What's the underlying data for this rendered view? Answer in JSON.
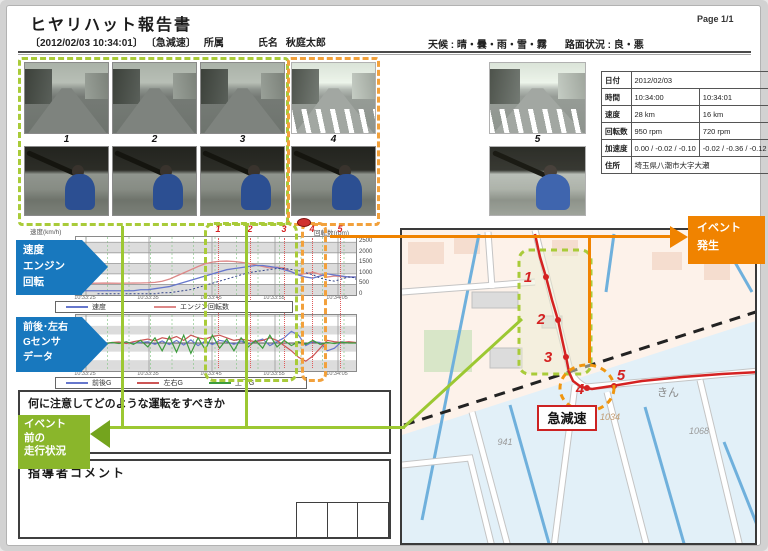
{
  "page": {
    "title": "ヒヤリハット報告書",
    "page_label": "Page 1/1",
    "timestamp": "〔2012/02/03 10:34:01〕",
    "event_type": "〔急減速〕",
    "affiliation_label": "所属",
    "name_label": "氏名",
    "person_name": "秋庭太郎",
    "weather": "天候 : 晴・曇・雨・雪・霧",
    "road_condition": "路面状況 : 良・悪"
  },
  "cameras": {
    "frames": [
      {
        "label": "1"
      },
      {
        "label": "2"
      },
      {
        "label": "3"
      },
      {
        "label": "4"
      },
      {
        "label": "5"
      }
    ]
  },
  "info_table": {
    "rows": [
      {
        "label": "日付",
        "values": [
          "2012/02/03"
        ]
      },
      {
        "label": "時間",
        "values": [
          "10:34:00",
          "10:34:01"
        ]
      },
      {
        "label": "速度",
        "values": [
          "28 km",
          "16 km"
        ]
      },
      {
        "label": "回転数",
        "values": [
          "950 rpm",
          "720 rpm"
        ]
      },
      {
        "label": "加速度",
        "values": [
          "0.00 / -0.02 / -0.10",
          "-0.02 / -0.36 / -0.12"
        ]
      },
      {
        "label": "住所",
        "values": [
          "埼玉県八潮市大字大瀬"
        ]
      }
    ]
  },
  "connectors": {
    "event_occur_lines": [
      "イベント",
      "発生"
    ],
    "event_before_lines": [
      "イベント",
      "前の",
      "走行状況"
    ],
    "colors": {
      "orange": "#f08300",
      "olive": "#9cc832"
    }
  },
  "arrow_labels": {
    "speed_engine_lines": [
      "速度",
      "エンジン",
      "回転"
    ],
    "gsensor_lines": [
      "前後･左右",
      "Gセンサ",
      "データ"
    ]
  },
  "chart_data": [
    {
      "type": "line",
      "title": "速度・エンジン回転",
      "left_axis_label": "速度(km/h)",
      "right_axis_label": "回転数(rpm)",
      "yticks_right": [
        "2500",
        "2000",
        "1500",
        "1000",
        "500",
        "0"
      ],
      "ylim_rpm": [
        0,
        2750
      ],
      "x": [
        "10:33:25",
        "10:33:35",
        "10:33:45",
        "10:33:55",
        "10:34:05"
      ],
      "event_markers": [
        "1",
        "2",
        "3",
        "4",
        "5"
      ],
      "series": [
        {
          "name": "速度",
          "color": "#6677cc",
          "unit": "km/h",
          "values": [
            4,
            4,
            4,
            4,
            4,
            4,
            4,
            4,
            4,
            5,
            5,
            6,
            7,
            8,
            10,
            12,
            14,
            16,
            18,
            20,
            22,
            24,
            25,
            26,
            27,
            28,
            28,
            27,
            26,
            24,
            22,
            19,
            17,
            16,
            18,
            20,
            19,
            18,
            17,
            17
          ]
        },
        {
          "name": "エンジン回転数",
          "color": "#dd8888",
          "unit": "rpm",
          "values": [
            560,
            560,
            555,
            560,
            565,
            560,
            558,
            562,
            565,
            570,
            580,
            600,
            650,
            750,
            900,
            1050,
            1200,
            1350,
            1480,
            1560,
            1600,
            1610,
            1590,
            1550,
            1500,
            1430,
            1350,
            1280,
            1320,
            1280,
            1100,
            950,
            1020,
            1080,
            980,
            850,
            900,
            870,
            860,
            850
          ]
        }
      ],
      "legend_position": "bottom"
    },
    {
      "type": "line",
      "title": "前後・左右Gセンサデータ",
      "ylim_g": [
        -1,
        1
      ],
      "x": [
        "10:33:25",
        "10:33:35",
        "10:33:45",
        "10:33:55",
        "10:34:05"
      ],
      "series": [
        {
          "name": "前後G",
          "color": "#6677cc",
          "values": [
            0,
            0,
            0.02,
            -0.02,
            0.01,
            0,
            0.02,
            0.01,
            -0.01,
            0.02,
            0.05,
            -0.05,
            0.08,
            -0.06,
            0.1,
            -0.08,
            0.12,
            -0.1,
            0.08,
            -0.06,
            0.1,
            0.05,
            -0.05,
            0.08,
            -0.04,
            0.06,
            0.15,
            -0.1,
            0.05,
            0.2,
            0.45,
            0.3,
            -0.1,
            0.05,
            0.02,
            -0.3,
            -0.2,
            0.05,
            0.02,
            0
          ]
        },
        {
          "name": "左右G",
          "color": "#cc5555",
          "values": [
            0.02,
            -0.02,
            0.03,
            0.05,
            -0.03,
            0.02,
            0.04,
            -0.02,
            0.05,
            0.1,
            0.15,
            0.08,
            0.2,
            0.15,
            0.25,
            0.1,
            0.3,
            0.2,
            0.15,
            0.25,
            0.3,
            0.2,
            0.1,
            0.15,
            0.1,
            0.05,
            0.1,
            0.2,
            0.1,
            -0.1,
            -0.3,
            -0.55,
            -0.7,
            -0.5,
            -0.2,
            0.1,
            0.05,
            0.02,
            0.05,
            0.02
          ]
        },
        {
          "name": "上下G",
          "color": "#3d9d3d",
          "values": [
            0,
            0.02,
            -0.02,
            0.03,
            -0.03,
            0.02,
            -0.02,
            0.05,
            -0.05,
            0.1,
            -0.15,
            0.2,
            -0.3,
            0.25,
            -0.35,
            0.3,
            -0.4,
            0.2,
            -0.25,
            0.3,
            -0.2,
            0.15,
            -0.3,
            0.2,
            -0.15,
            0.1,
            -0.2,
            0.3,
            -0.15,
            0.1,
            -0.1,
            0.05,
            -0.05,
            0.1,
            -0.05,
            0.02,
            -0.02,
            0.03,
            0,
            0
          ]
        }
      ],
      "legend_position": "bottom"
    }
  ],
  "bottom": {
    "question_label": "何に注意してどのような運転をすべきか",
    "coach_label": "指導者コメント"
  },
  "map": {
    "speed_event_label": "急減速",
    "route_points": [
      {
        "label": "1"
      },
      {
        "label": "2"
      },
      {
        "label": "3"
      },
      {
        "label": "4"
      },
      {
        "label": "5"
      }
    ],
    "parcels": [
      "941",
      "1034",
      "1068"
    ],
    "place_note": "きん",
    "route_color": "#d42222"
  }
}
